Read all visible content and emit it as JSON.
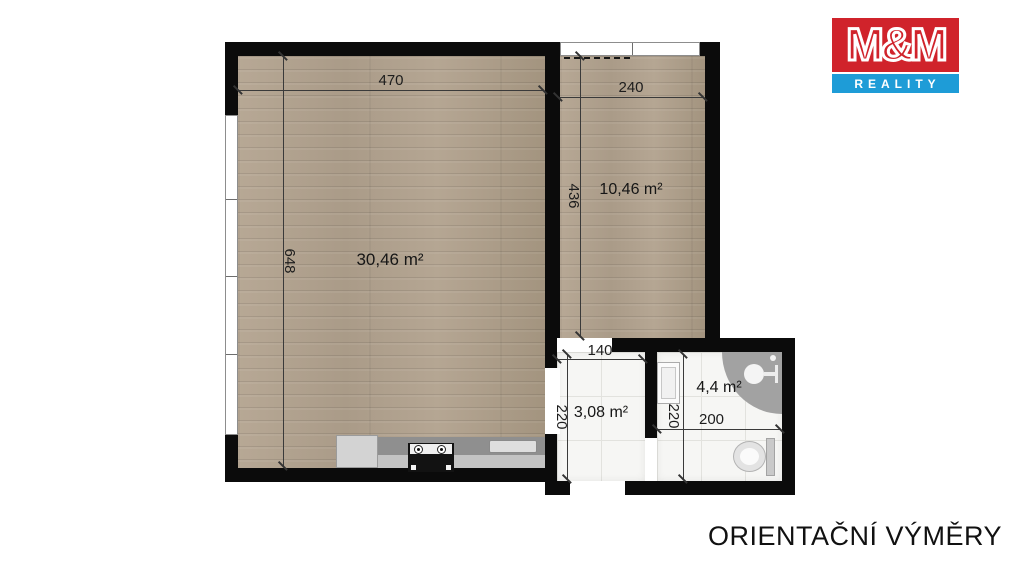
{
  "title": "Floor plan – orientational measurements",
  "logo": {
    "line1": "M&M",
    "line2": "REALITY",
    "red": "#d0232b",
    "blue": "#1e9cd7"
  },
  "footer": {
    "label": "ORIENTAČNÍ VÝMĚRY"
  },
  "rooms": {
    "living": {
      "area": "30,46 m²"
    },
    "bedroom": {
      "area": "10,46 m²"
    },
    "hall": {
      "area": "3,08 m²"
    },
    "bath": {
      "area": "4,4 m²"
    }
  },
  "dims": {
    "d470": {
      "label": "470"
    },
    "d240": {
      "label": "240"
    },
    "d648": {
      "label": "648"
    },
    "d436": {
      "label": "436"
    },
    "d140": {
      "label": "140"
    },
    "d220_hall": {
      "label": "220"
    },
    "d200": {
      "label": "200"
    },
    "d220_bath": {
      "label": "220"
    }
  },
  "colors": {
    "wall": "#0b0b0b",
    "wood_floor": "#b1a28f",
    "tile_floor": "#f6f6f4",
    "dimension_line": "#3a3a3a"
  }
}
